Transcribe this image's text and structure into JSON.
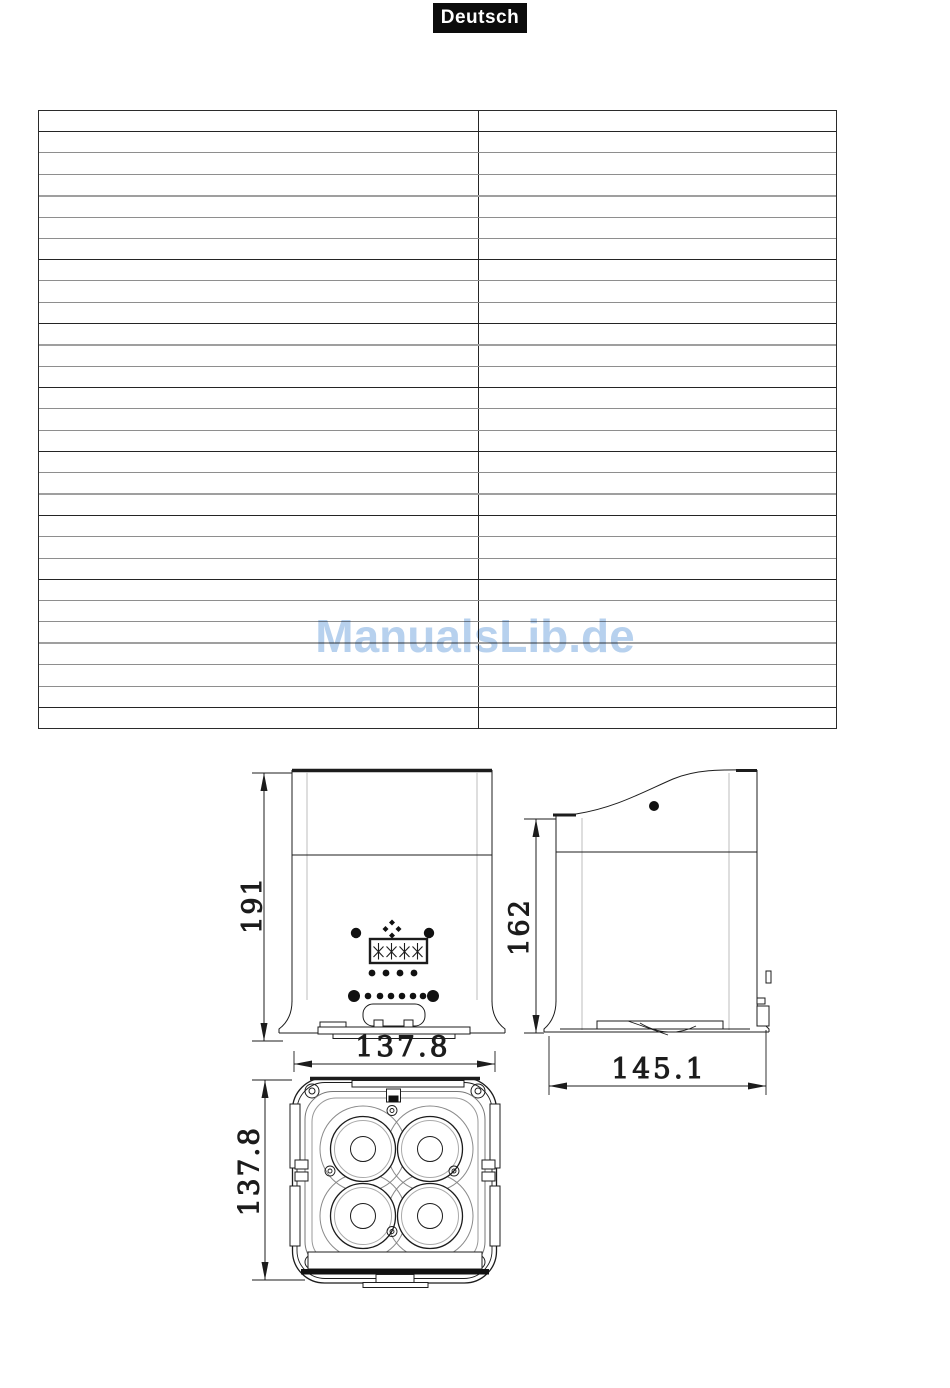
{
  "page": {
    "language_badge": "Deutsch"
  },
  "watermark": {
    "text": "ManualsLib.de",
    "color": "#b7d1ee"
  },
  "spec_table": {
    "row_count": 29,
    "column_count": 2,
    "note": "table grid rendered with no visible cell text",
    "cells": []
  },
  "drawings": {
    "front_view": {
      "height_label": "191",
      "width_label": "137.8"
    },
    "side_view": {
      "height_label": "162",
      "depth_label": "145.1"
    },
    "bottom_view": {
      "height_label": "137.8"
    }
  }
}
